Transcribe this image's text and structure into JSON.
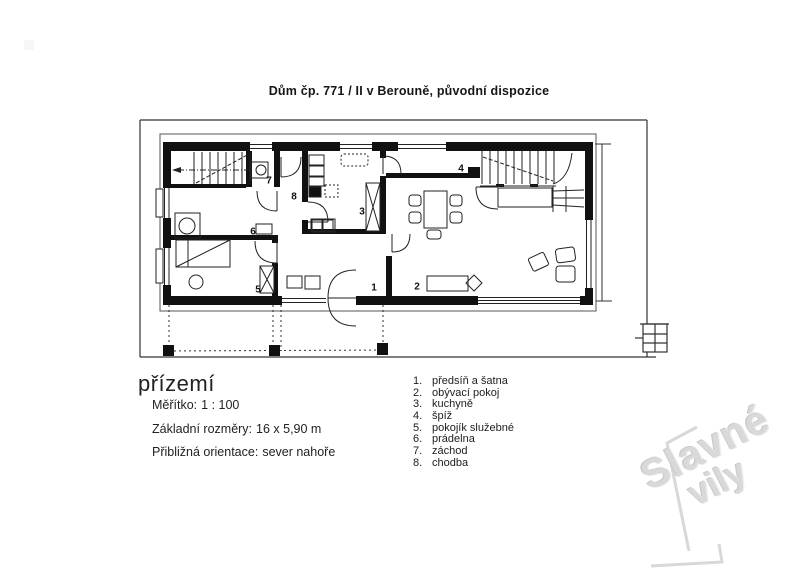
{
  "page": {
    "title": "Dům čp. 771 / II  v Berouně, původní dispozice"
  },
  "footer": {
    "floor": "přízemí",
    "rows": [
      {
        "label": "Měřítko:",
        "value": "1 : 100"
      },
      {
        "label": "Základní rozměry:",
        "value": "16 x 5,90 m"
      },
      {
        "label": "Přibližná orientace:",
        "value": "sever nahoře"
      }
    ]
  },
  "legend": {
    "items": [
      {
        "number": "1.",
        "label": "předsíň a šatna"
      },
      {
        "number": "2.",
        "label": "obývací pokoj"
      },
      {
        "number": "3.",
        "label": "kuchyně"
      },
      {
        "number": "4.",
        "label": "špíž"
      },
      {
        "number": "5.",
        "label": "pokojík služebné"
      },
      {
        "number": "6.",
        "label": "prádelna"
      },
      {
        "number": "7.",
        "label": "záchod"
      },
      {
        "number": "8.",
        "label": "chodba"
      }
    ]
  },
  "plan": {
    "room_numbers": [
      "1",
      "2",
      "3",
      "4",
      "5",
      "6",
      "7",
      "8"
    ]
  },
  "watermark": {
    "line1": "Slavné",
    "line2": "vily"
  },
  "colors": {
    "ink": "#1a1a1a",
    "wall": "#111111",
    "paper": "#ffffff",
    "watermark": "#d9d9d9"
  }
}
